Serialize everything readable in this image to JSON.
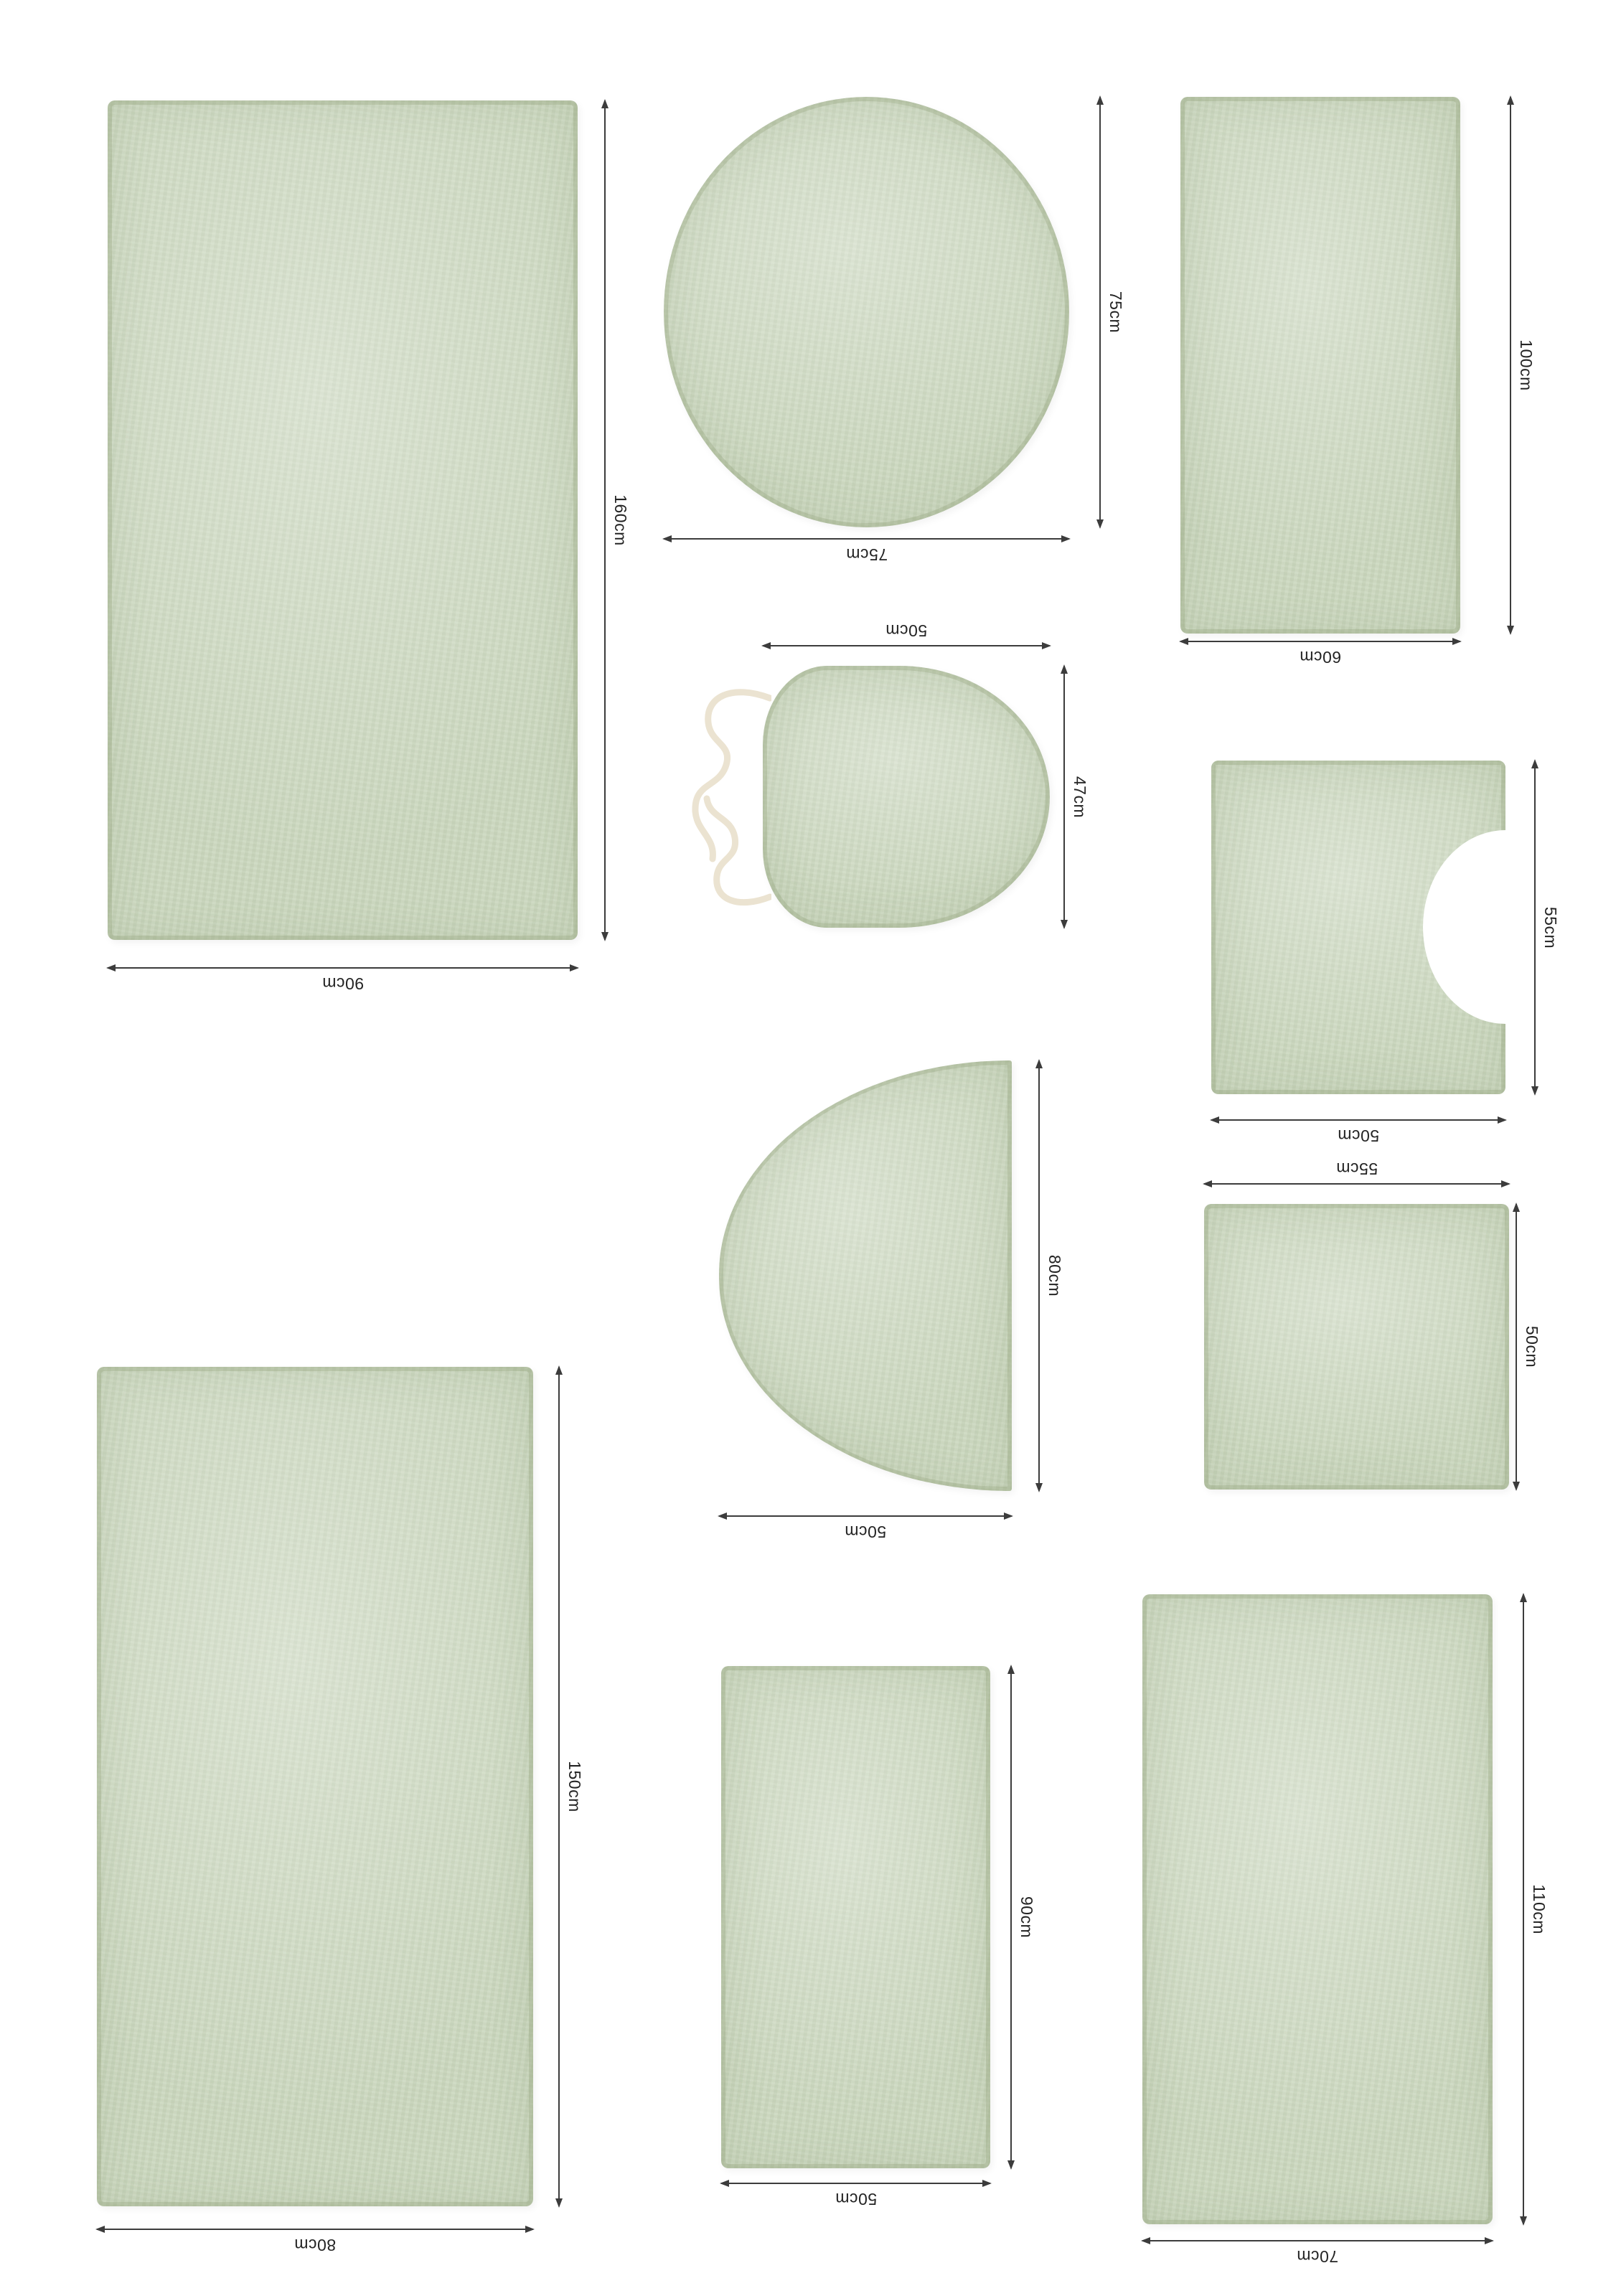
{
  "colors": {
    "rug_fill": "#ccd8c0",
    "rug_edge": "#b7c6a6",
    "dimension_line": "#3c3c3c",
    "label_text": "#242424",
    "drawstring": "#ebe3d1",
    "background": "#ffffff"
  },
  "rugs": [
    {
      "id": "rect-90x160",
      "shape": "rectangle",
      "width_label": "90cm",
      "height_label": "160cm"
    },
    {
      "id": "circle-75",
      "shape": "circle",
      "width_label": "75cm",
      "height_label": "75cm"
    },
    {
      "id": "rect-60x100",
      "shape": "rectangle",
      "width_label": "60cm",
      "height_label": "100cm"
    },
    {
      "id": "toilet-lid-cover",
      "shape": "toilet-lid-cover",
      "width_label": "50cm",
      "height_label": "47cm"
    },
    {
      "id": "contour-mat-50x55",
      "shape": "contour-u-mat",
      "width_label": "50cm",
      "height_label": "55cm"
    },
    {
      "id": "half-circle-50x80",
      "shape": "half-circle",
      "width_label": "50cm",
      "height_label": "80cm"
    },
    {
      "id": "square-55x50",
      "shape": "square",
      "width_label": "55cm",
      "height_label": "50cm"
    },
    {
      "id": "rect-80x150",
      "shape": "rectangle",
      "width_label": "80cm",
      "height_label": "150cm"
    },
    {
      "id": "rect-50x90",
      "shape": "rectangle",
      "width_label": "50cm",
      "height_label": "90cm"
    },
    {
      "id": "rect-70x110",
      "shape": "rectangle",
      "width_label": "70cm",
      "height_label": "110cm"
    }
  ]
}
